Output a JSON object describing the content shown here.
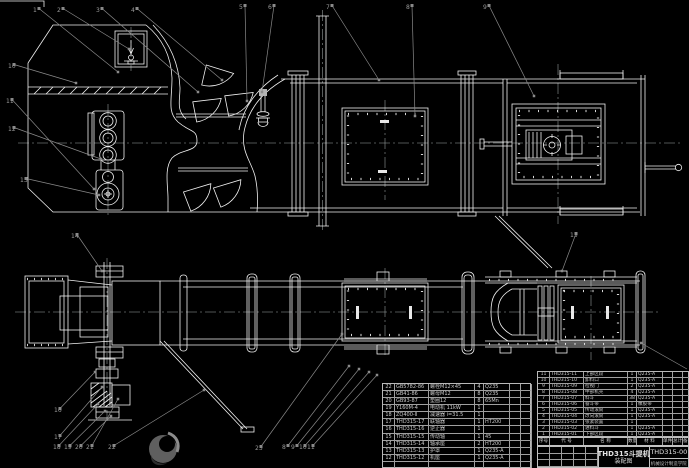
{
  "colors": {
    "background": "#000000",
    "line": "#f0f0f0",
    "leader": "#8a8a8a",
    "table_text": "#c9c9c9"
  },
  "title_block": {
    "product": "THD315斗提机",
    "sheet": "装配图",
    "number": "THD315-00",
    "org": "机械设计制造学院"
  },
  "bom_right": {
    "header": [
      "序号",
      "代 号",
      "名 称",
      "数量",
      "材 料",
      "单件",
      "总计",
      "备注"
    ],
    "rows": [
      [
        "11",
        "THD315-11",
        "上部区段",
        "1",
        "Q235-A",
        "",
        "",
        ""
      ],
      [
        "10",
        "THD315-10",
        "卸料口",
        "1",
        "Q235-A",
        "",
        "",
        ""
      ],
      [
        "9",
        "THD315-09",
        "检视门",
        "2",
        "Q235-A",
        "",
        "",
        ""
      ],
      [
        "8",
        "THD315-08",
        "中部机壳",
        "4",
        "Q235-A",
        "",
        "",
        ""
      ],
      [
        "7",
        "THD315-07",
        "料斗",
        "38",
        "Q235-A",
        "",
        "",
        ""
      ],
      [
        "6",
        "THD315-06",
        "畚斗带",
        "1",
        "橡胶带",
        "",
        "",
        ""
      ],
      [
        "5",
        "THD315-05",
        "传动滚筒",
        "1",
        "Q235-A",
        "",
        "",
        ""
      ],
      [
        "4",
        "THD315-04",
        "改向滚筒",
        "1",
        "Q235-A",
        "",
        "",
        ""
      ],
      [
        "3",
        "THD315-03",
        "张紧装置",
        "1",
        "",
        "",
        "",
        ""
      ],
      [
        "2",
        "THD315-02",
        "进料斗",
        "1",
        "Q235-A",
        "",
        "",
        ""
      ],
      [
        "1",
        "THD315-01",
        "下部区段",
        "1",
        "Q235-A",
        "",
        "",
        ""
      ]
    ]
  },
  "bom_left": {
    "rows": [
      [
        "22",
        "GB5782-86",
        "螺栓M12×45",
        "4",
        "Q235",
        "",
        ""
      ],
      [
        "21",
        "GB41-86",
        "螺母M12",
        "8",
        "Q235",
        "",
        ""
      ],
      [
        "20",
        "GB93-87",
        "垫圈12",
        "8",
        "65Mn",
        "",
        ""
      ],
      [
        "19",
        "Y160M-4",
        "电动机 11kW",
        "1",
        "",
        "",
        ""
      ],
      [
        "18",
        "ZQ400-Ⅱ",
        "减速器 i=31.5",
        "1",
        "",
        "",
        ""
      ],
      [
        "17",
        "THD315-17",
        "联轴器",
        "1",
        "HT200",
        "",
        ""
      ],
      [
        "16",
        "THD315-16",
        "逆止器",
        "1",
        "",
        "",
        ""
      ],
      [
        "15",
        "THD315-15",
        "传动轴",
        "1",
        "45",
        "",
        ""
      ],
      [
        "14",
        "THD315-14",
        "轴承座",
        "2",
        "HT200",
        "",
        ""
      ],
      [
        "13",
        "THD315-13",
        "护罩",
        "1",
        "Q235-A",
        "",
        ""
      ],
      [
        "12",
        "THD315-12",
        "机座",
        "1",
        "Q235-A",
        "",
        ""
      ],
      [
        "",
        "",
        "",
        "",
        "",
        "",
        ""
      ]
    ]
  },
  "balloons": [
    {
      "n": "1",
      "x": 33,
      "y": 12,
      "tx": 118,
      "ty": 72
    },
    {
      "n": "2",
      "x": 57,
      "y": 12,
      "tx": 129,
      "ty": 49
    },
    {
      "n": "3",
      "x": 96,
      "y": 12,
      "tx": 198,
      "ty": 92
    },
    {
      "n": "4",
      "x": 131,
      "y": 12,
      "tx": 222,
      "ty": 80
    },
    {
      "n": "5",
      "x": 239,
      "y": 9,
      "tx": 247,
      "ty": 101
    },
    {
      "n": "6",
      "x": 268,
      "y": 9,
      "tx": 262,
      "ty": 92
    },
    {
      "n": "7",
      "x": 326,
      "y": 9,
      "tx": 379,
      "ty": 80
    },
    {
      "n": "8",
      "x": 406,
      "y": 9,
      "tx": 415,
      "ty": 116
    },
    {
      "n": "9",
      "x": 483,
      "y": 9,
      "tx": 534,
      "ty": 96
    },
    {
      "n": "10",
      "x": 8,
      "y": 68,
      "tx": 76,
      "ty": 83
    },
    {
      "n": "11",
      "x": 6,
      "y": 103,
      "tx": 94,
      "ty": 189
    },
    {
      "n": "12",
      "x": 8,
      "y": 131,
      "tx": 101,
      "ty": 159
    },
    {
      "n": "13",
      "x": 20,
      "y": 182,
      "tx": 99,
      "ty": 195
    },
    {
      "n": "14",
      "x": 71,
      "y": 238,
      "tx": 102,
      "ty": 271
    },
    {
      "n": "15",
      "x": 570,
      "y": 237,
      "tx": 562,
      "ty": 271
    },
    {
      "n": "16",
      "x": 54,
      "y": 412,
      "tx": 95,
      "ty": 372
    },
    {
      "n": "17",
      "x": 54,
      "y": 439,
      "tx": 102,
      "ty": 387
    },
    {
      "n": "18",
      "x": 53,
      "y": 449,
      "tx": 98,
      "ty": 404
    },
    {
      "n": "19",
      "x": 64,
      "y": 449,
      "tx": 105,
      "ty": 411
    },
    {
      "n": "20",
      "x": 75,
      "y": 449,
      "tx": 111,
      "ty": 416
    },
    {
      "n": "21",
      "x": 86,
      "y": 449,
      "tx": 118,
      "ty": 399
    },
    {
      "n": "22",
      "x": 108,
      "y": 449,
      "tx": 204,
      "ty": 390
    },
    {
      "n": "23",
      "x": 255,
      "y": 450,
      "tx": 342,
      "ty": 334
    },
    {
      "n": "8",
      "x": 282,
      "y": 449,
      "tx": 349,
      "ty": 366
    },
    {
      "n": "9",
      "x": 291,
      "y": 449,
      "tx": 359,
      "ty": 369
    },
    {
      "n": "10",
      "x": 299,
      "y": 449,
      "tx": 369,
      "ty": 372
    },
    {
      "n": "11",
      "x": 307,
      "y": 449,
      "tx": 377,
      "ty": 375
    },
    {
      "n": "",
      "x": 687,
      "y": 369,
      "tx": 641,
      "ty": 343
    }
  ]
}
